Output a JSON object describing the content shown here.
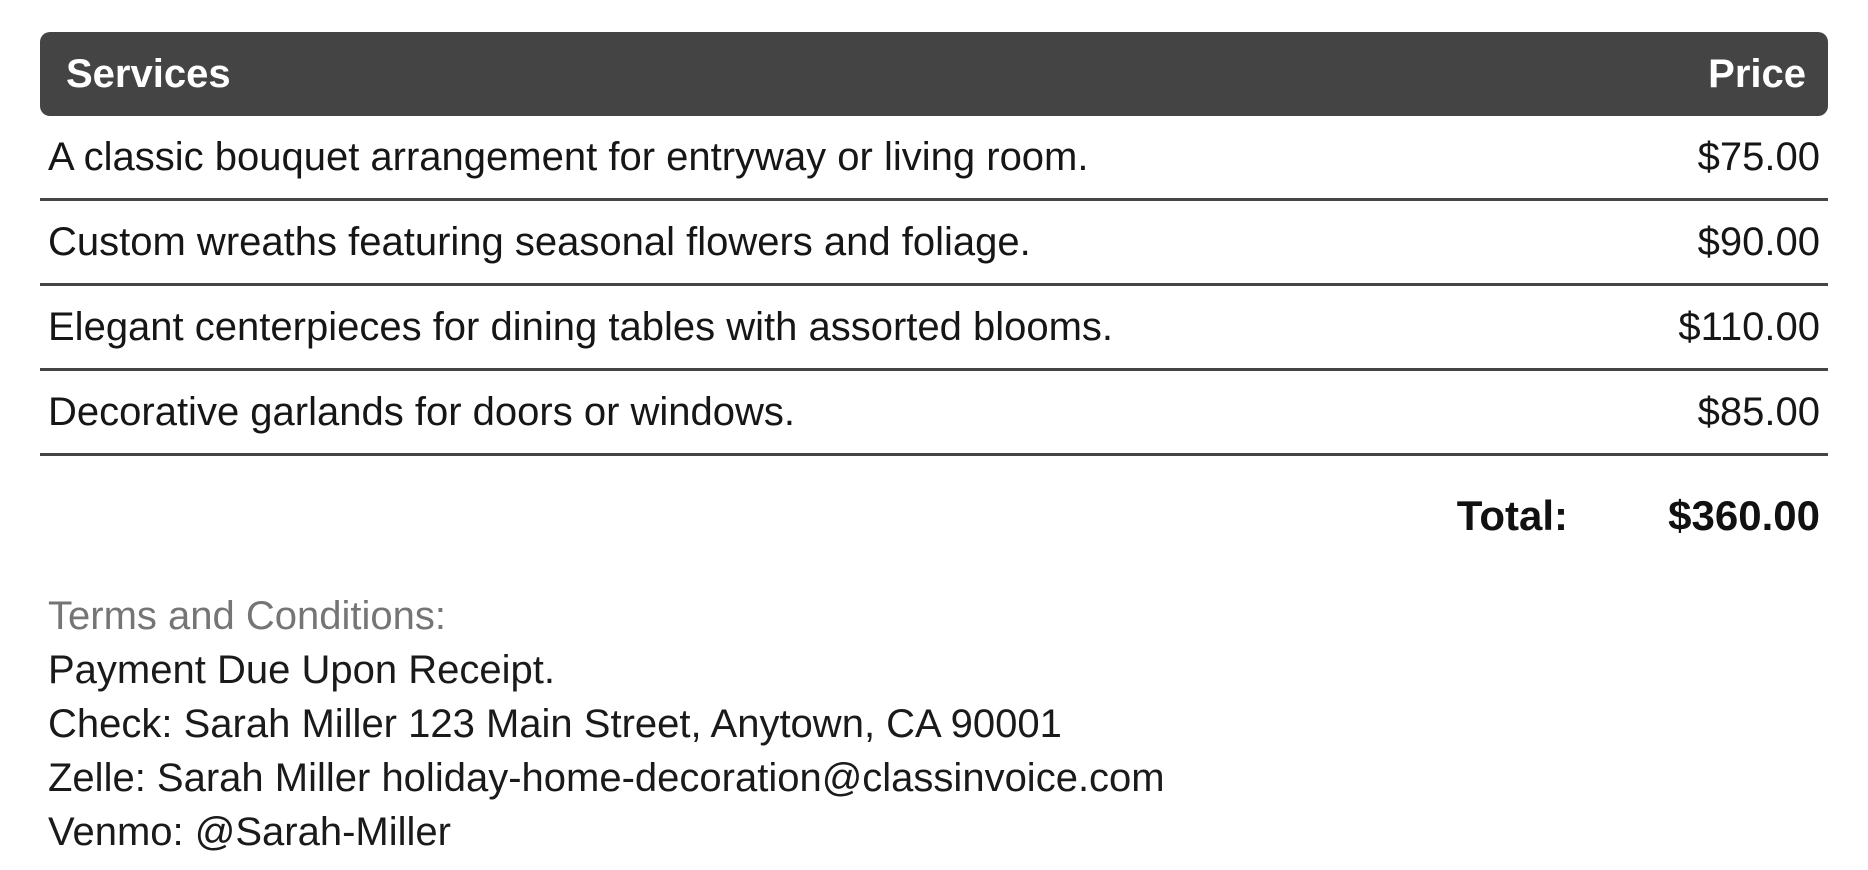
{
  "table": {
    "headers": [
      "Services",
      "Price"
    ],
    "rows": [
      {
        "service": "A classic bouquet arrangement for entryway or living room.",
        "price": "$75.00"
      },
      {
        "service": "Custom wreaths featuring seasonal flowers and foliage.",
        "price": "$90.00"
      },
      {
        "service": "Elegant centerpieces for dining tables with assorted blooms.",
        "price": "$110.00"
      },
      {
        "service": "Decorative garlands for doors or windows.",
        "price": "$85.00"
      }
    ],
    "total_label": "Total:",
    "total_value": "$360.00"
  },
  "terms": {
    "heading": "Terms and Conditions:",
    "lines": [
      "Payment Due Upon Receipt.",
      "Check: Sarah Miller 123 Main Street, Anytown, CA 90001",
      "Zelle: Sarah Miller holiday-home-decoration@classinvoice.com",
      "Venmo: @Sarah-Miller"
    ]
  },
  "colors": {
    "header_bg": "#444444",
    "header_text": "#ffffff",
    "divider": "#454545",
    "body_text": "#161616",
    "terms_heading_text": "#757575"
  }
}
